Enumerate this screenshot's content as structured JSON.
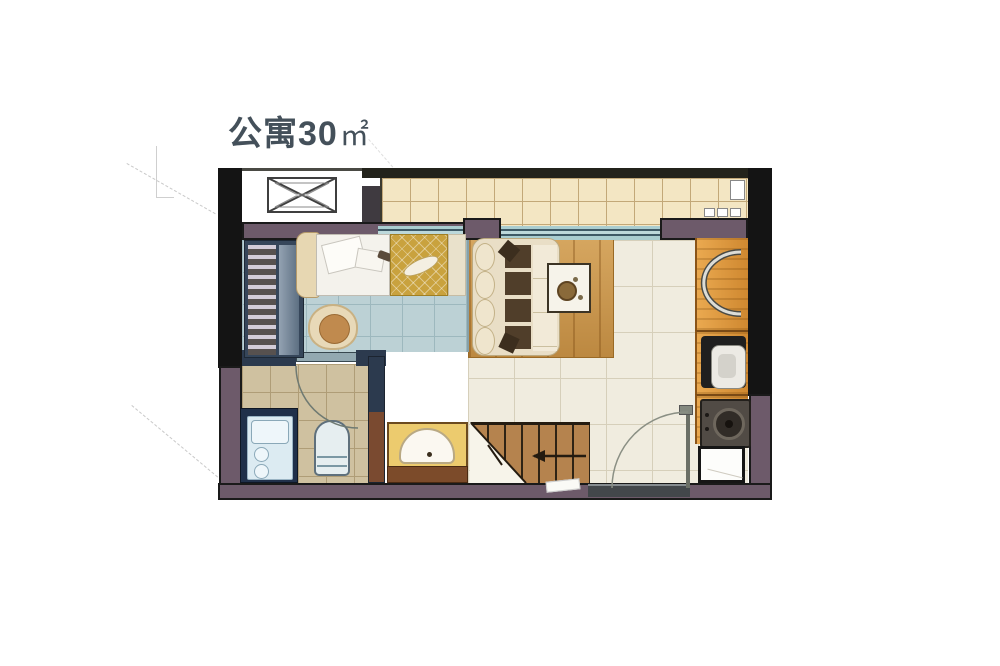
{
  "title": {
    "main": "公寓30",
    "unit": "㎡",
    "full": "公寓30㎡"
  },
  "plan": {
    "building_type": "公寓",
    "area_value": "30",
    "area_unit": "㎡"
  },
  "colors": {
    "title_color": "#44505a",
    "wall_dark": "#141414",
    "wall_purple": "#6d5a6a",
    "floor_bedroom": "#bcd1d5",
    "floor_living": "#f0ecdf",
    "floor_bath": "#cfc1a0",
    "balcony_tile": "#f3e6c3",
    "window_glass": "#a9cdd0",
    "rug_wood": "#c8944a",
    "kitchen_wood": "#cf8830",
    "bed_gold": "#c9a23e",
    "stairs_wood": "#b5834e",
    "basin_gold": "#eccb6e",
    "sofa_cream": "#e9dec6"
  }
}
